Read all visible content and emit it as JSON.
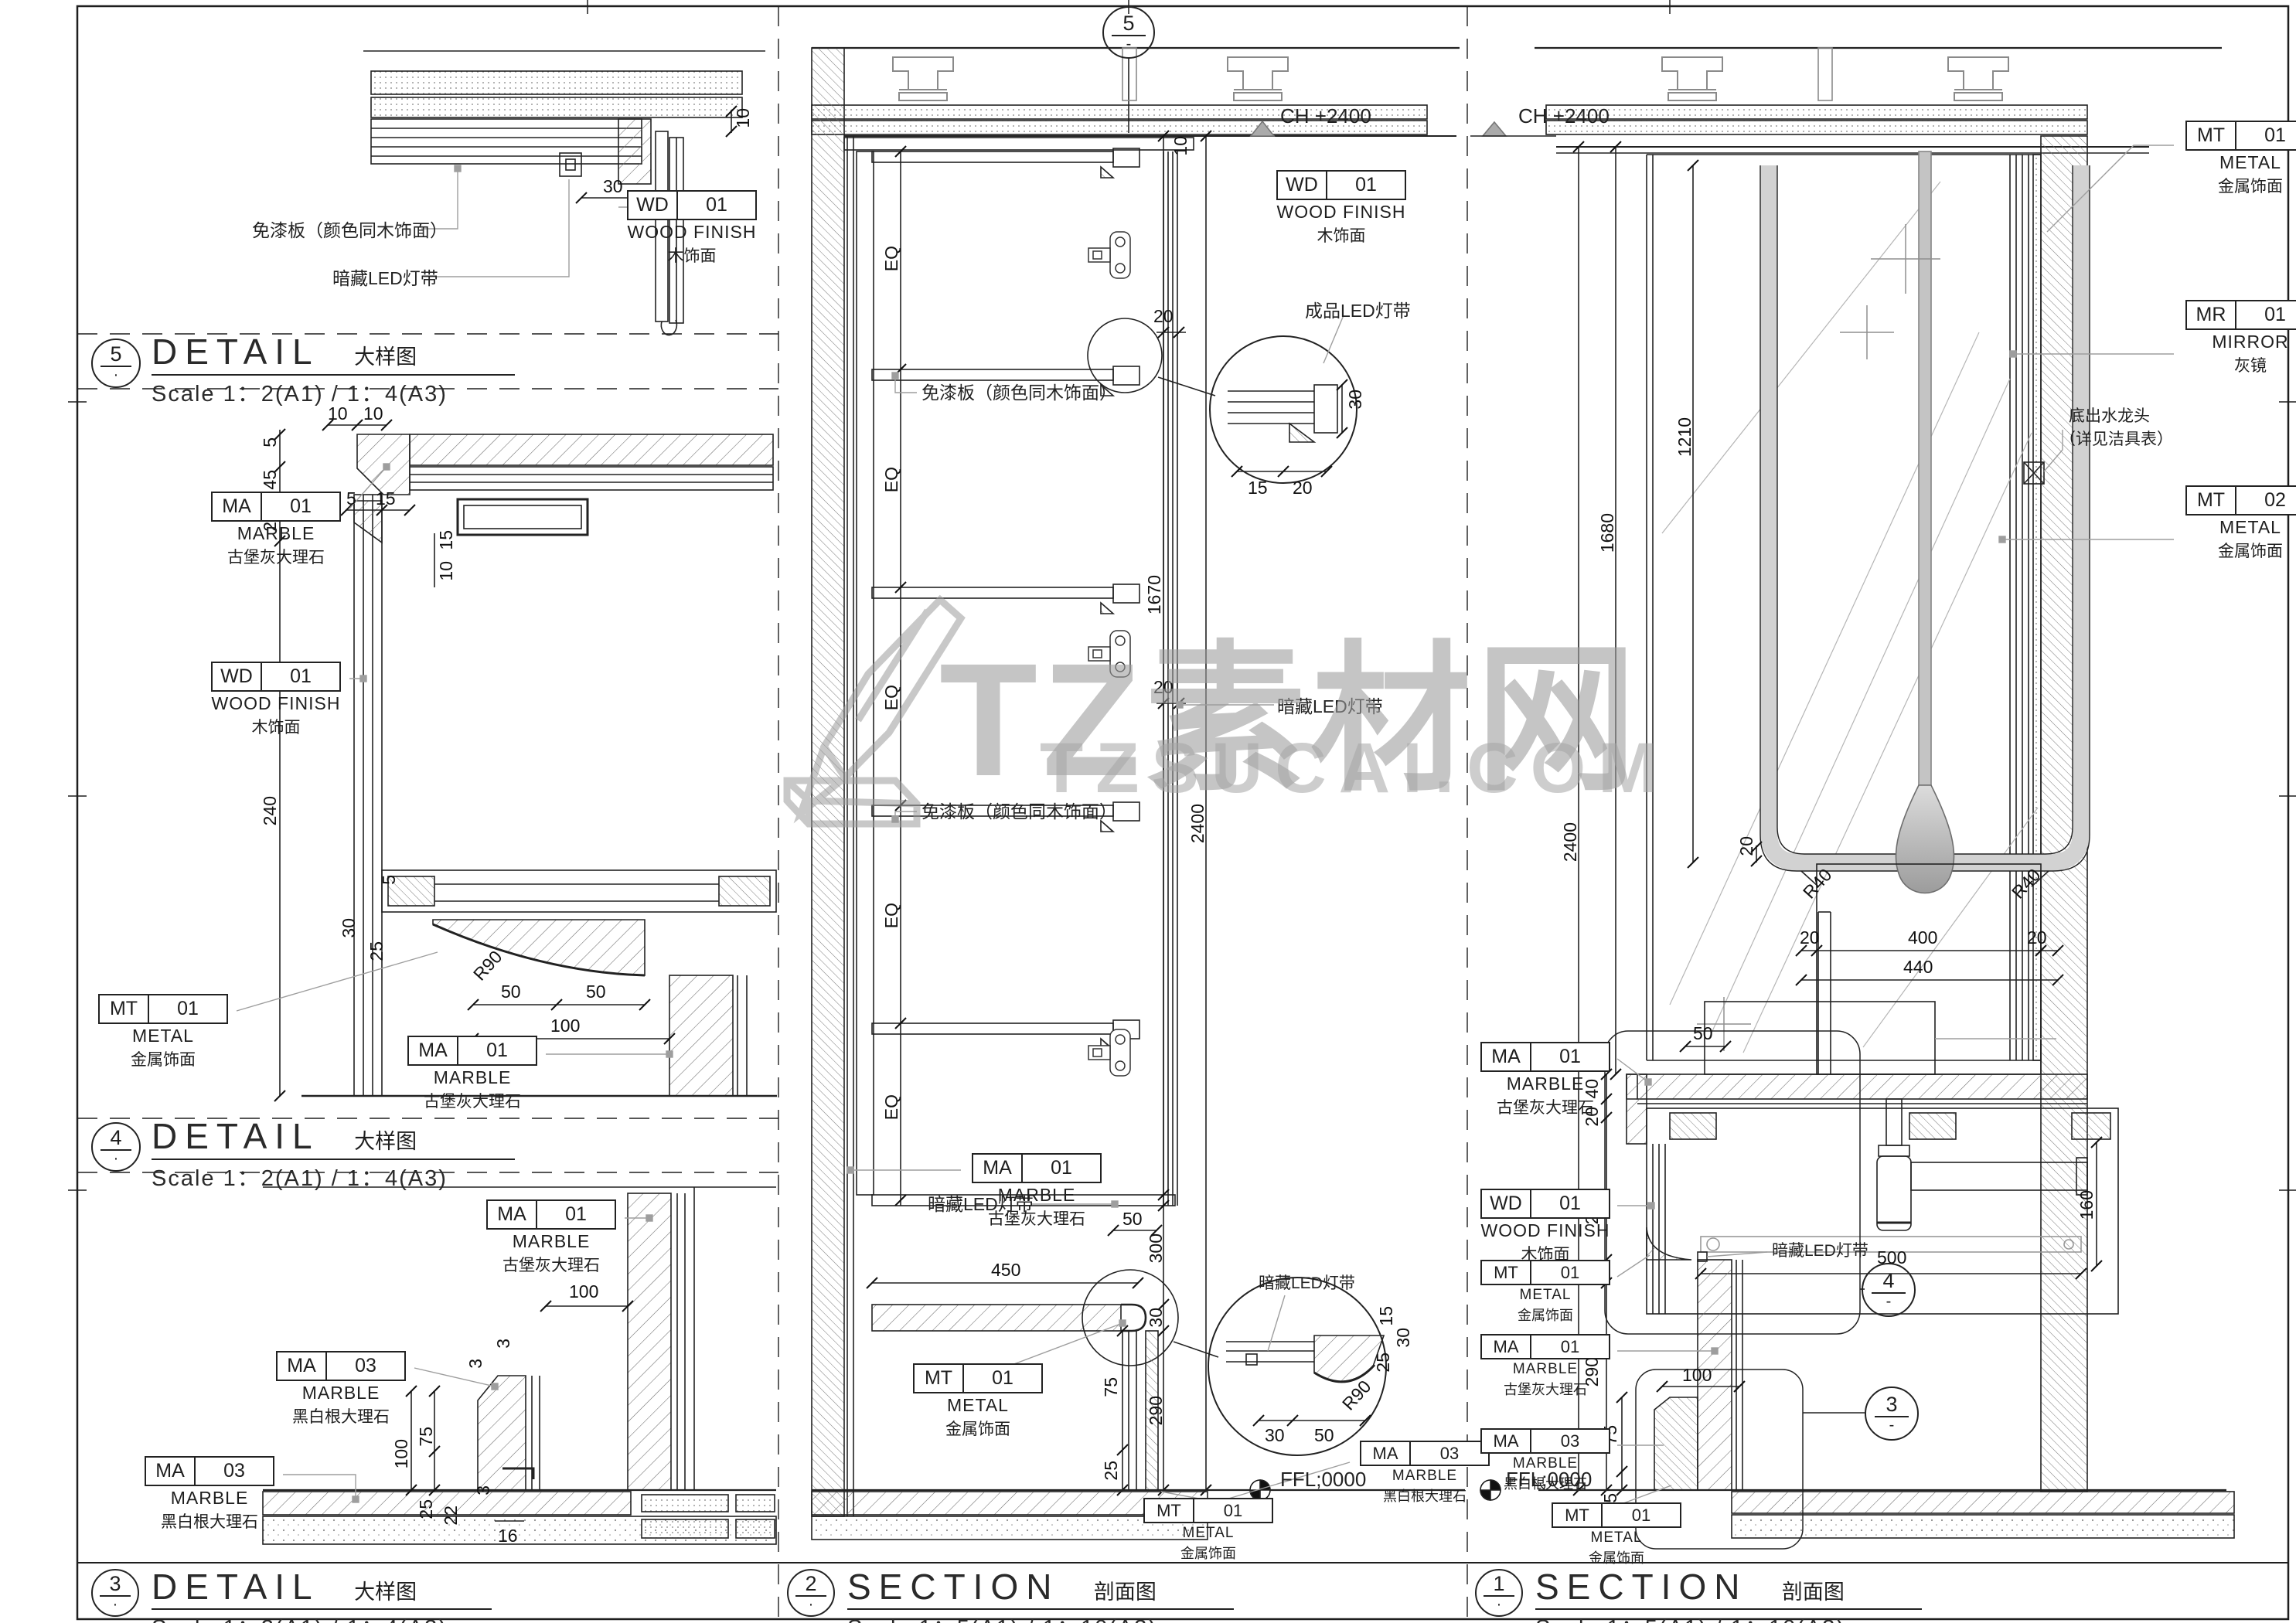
{
  "watermark": {
    "title": "TZ素材网",
    "url": "TZSUCAI.COM"
  },
  "callouts": {
    "c1": "1",
    "c2": "2",
    "c3": "3",
    "c4": "4",
    "c5": "5",
    "sub": "·",
    "dash": "-"
  },
  "titles": {
    "d5": {
      "num": "5",
      "name": "DETAIL",
      "cn": "大样图",
      "scale": "Scale 1：2(A1) / 1：4(A3)"
    },
    "d4": {
      "num": "4",
      "name": "DETAIL",
      "cn": "大样图",
      "scale": "Scale 1：2(A1) / 1：4(A3)"
    },
    "d3": {
      "num": "3",
      "name": "DETAIL",
      "cn": "大样图",
      "scale": "Scale 1：2(A1) / 1：4(A3)"
    },
    "s2": {
      "num": "2",
      "name": "SECTION",
      "cn": "剖面图",
      "scale": "Scale 1：5(A1) / 1：10(A3)"
    },
    "s1": {
      "num": "1",
      "name": "SECTION",
      "cn": "剖面图",
      "scale": "Scale 1：5(A1) / 1：10(A3)"
    }
  },
  "materials": {
    "wd01": {
      "code": "WD",
      "num": "01",
      "en": "WOOD FINISH",
      "cn": "木饰面"
    },
    "ma01": {
      "code": "MA",
      "num": "01",
      "en": "MARBLE",
      "cn": "古堡灰大理石"
    },
    "ma03": {
      "code": "MA",
      "num": "03",
      "en": "MARBLE",
      "cn": "黑白根大理石"
    },
    "mt01": {
      "code": "MT",
      "num": "01",
      "en": "METAL",
      "cn": "金属饰面"
    },
    "mt02": {
      "code": "MT",
      "num": "02",
      "en": "METAL",
      "cn": "金属饰面"
    },
    "mr01": {
      "code": "MR",
      "num": "01",
      "en": "MIRROR",
      "cn": "灰镜"
    }
  },
  "notes": {
    "panel": "免漆板（颜色同木饰面）",
    "led": "暗藏LED灯带",
    "led_product": "成品LED灯带",
    "faucet1": "底出水龙头",
    "faucet2": "（详见洁具表）",
    "ch": "CH +2400",
    "ffl": "FFL;0000"
  },
  "dims": {
    "n3": "3",
    "n5": "5",
    "n10": "10",
    "n15": "15",
    "n16": "16",
    "n20": "20",
    "n22": "22",
    "n25": "25",
    "n30": "30",
    "n40": "40",
    "n45": "45",
    "n50": "50",
    "n75": "75",
    "n100": "100",
    "n160": "160",
    "n240": "240",
    "n290": "290",
    "n300": "300",
    "n400": "400",
    "n440": "440",
    "n450": "450",
    "n500": "500",
    "n1210": "1210",
    "n1670": "1670",
    "n1680": "1680",
    "n2400": "2400",
    "r40": "R40",
    "r90": "R90",
    "eq": "EQ"
  }
}
